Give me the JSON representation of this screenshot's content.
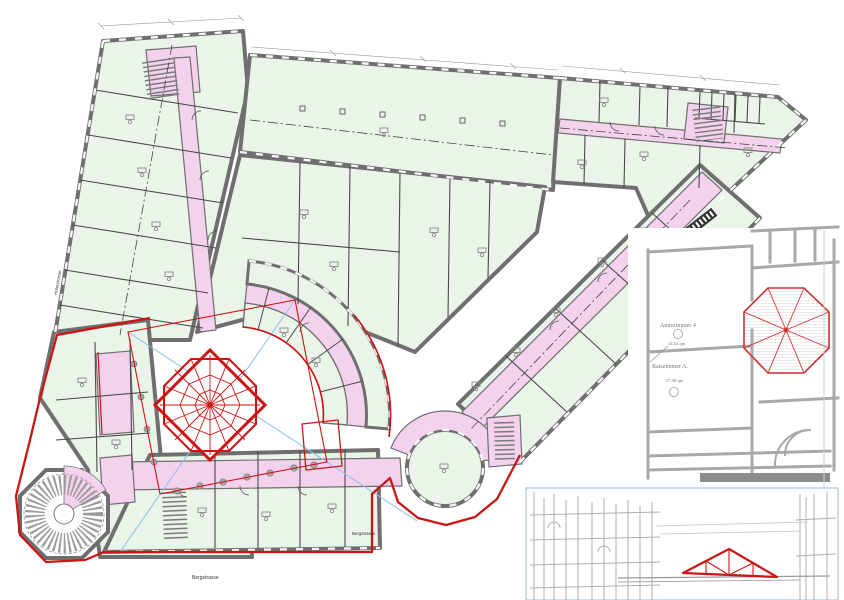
{
  "plan": {
    "street_labels": {
      "bottom": "Bergstrasse",
      "middle": "Bergstrasse",
      "left": "Hohestrasse"
    }
  },
  "insets": {
    "historical_plan": {
      "room1_label": "Amtszimmer 4",
      "room1_area": "34,54 qm",
      "room2_label": "Ratszimmer A.",
      "room2_area": "27,58 qm"
    }
  },
  "colors": {
    "room_green": "#eaf4e8",
    "corridor_pink": "#f4d2ee",
    "wall_gray": "#6f6f6f",
    "highlight_red": "#cc1414",
    "axis_blue": "#8fc0e8",
    "inset_gray": "#a8a8a8",
    "inset_border_blue": "#a9c7e0"
  }
}
